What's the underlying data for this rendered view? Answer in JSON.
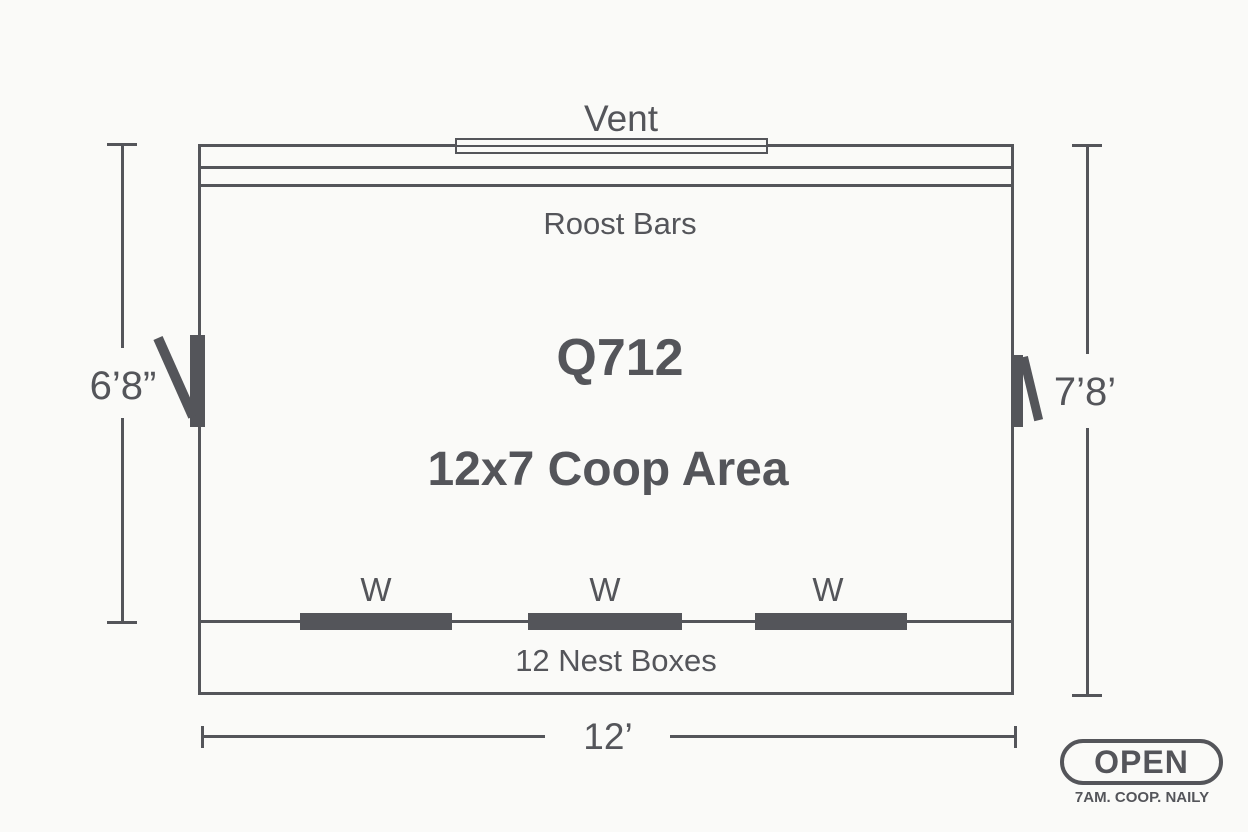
{
  "colors": {
    "ink": "#54555a",
    "bg": "#fafaf8"
  },
  "plan": {
    "vent_label": "Vent",
    "roost_label": "Roost Bars",
    "model": "Q712",
    "area_label": "12x7 Coop Area",
    "windows": [
      "W",
      "W",
      "W"
    ],
    "nest_label": "12 Nest Boxes"
  },
  "dimensions": {
    "left": "6’8”",
    "right": "7’8’",
    "bottom": "12’"
  },
  "badge": {
    "title": "OPEN",
    "subtitle": "7AM. COOP. NAILY"
  }
}
